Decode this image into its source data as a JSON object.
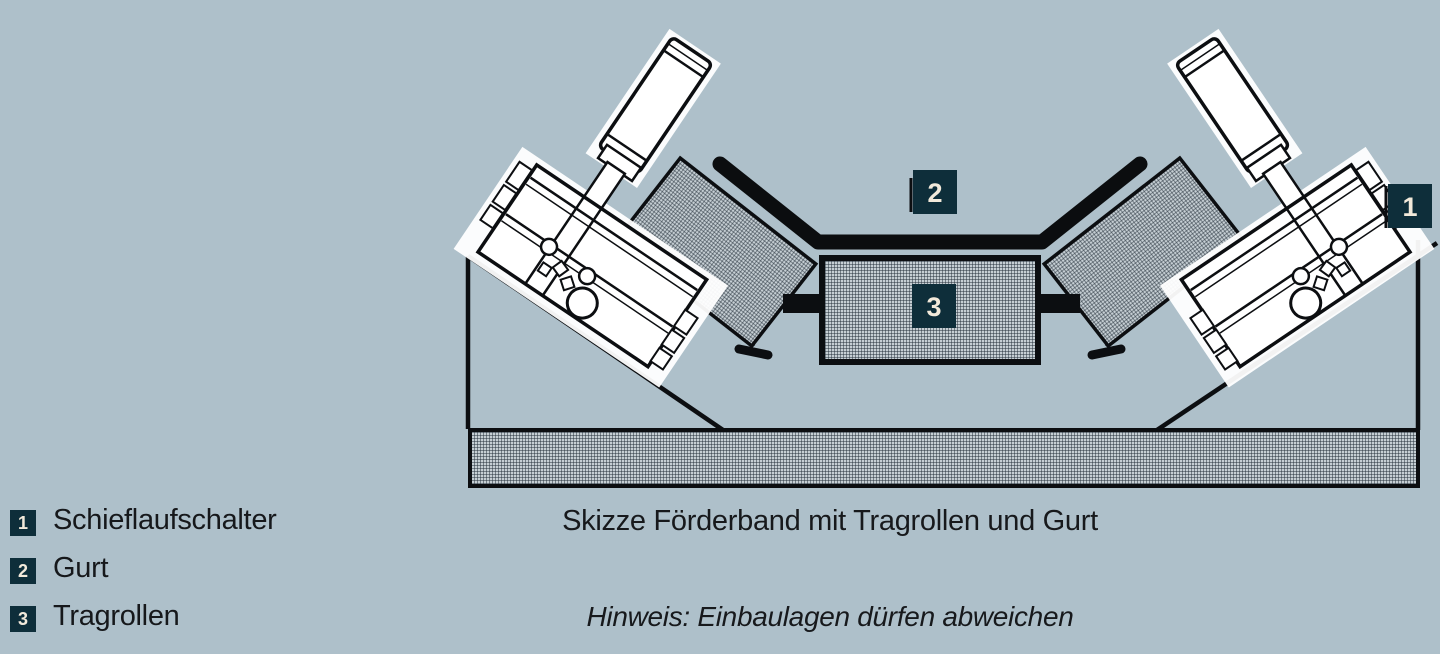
{
  "colors": {
    "background": "#aec0ca",
    "badge_background": "#0e2e3a",
    "badge_text": "#f2e9da",
    "line_ink": "#0c0e11",
    "hatch_base": "#c6cfd4",
    "text": "#17191c"
  },
  "legend": {
    "items": [
      {
        "number": "1",
        "label": "Schieflaufschalter"
      },
      {
        "number": "2",
        "label": "Gurt"
      },
      {
        "number": "3",
        "label": "Tragrollen"
      }
    ]
  },
  "caption": {
    "title": "Skizze Förderband mit Tragrollen und Gurt",
    "note": "Hinweis: Einbaulagen dürfen abweichen"
  },
  "diagram": {
    "badge_switch": "1",
    "badge_belt": "2",
    "badge_idlers": "3"
  }
}
